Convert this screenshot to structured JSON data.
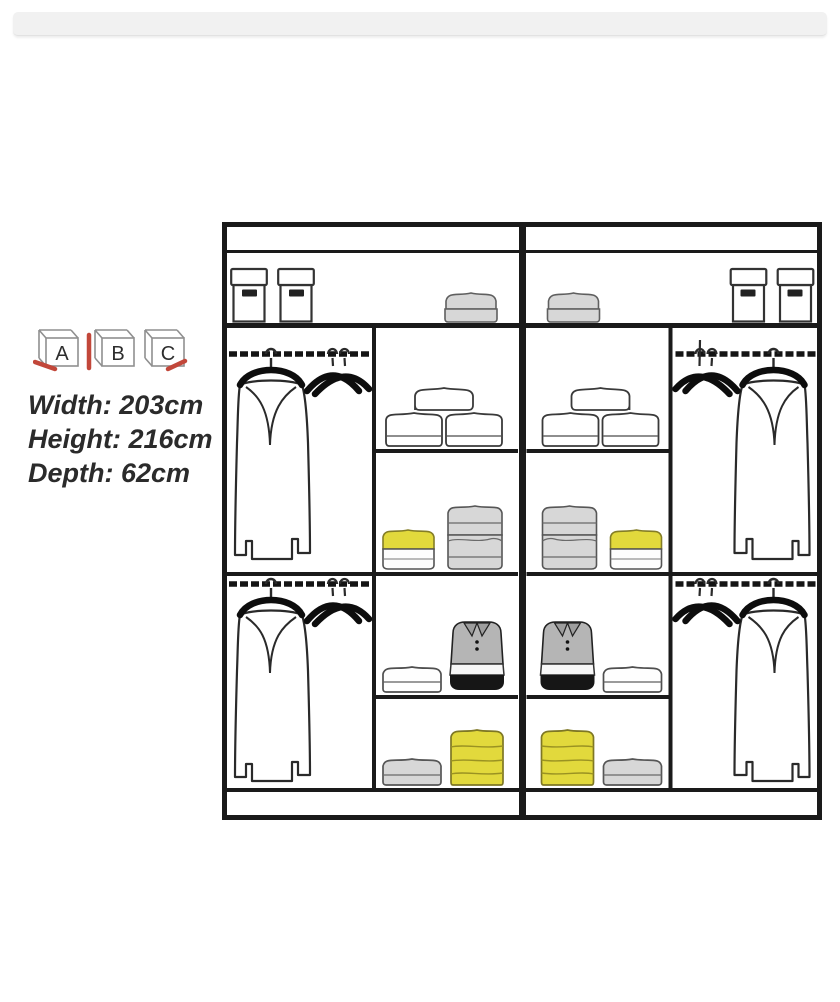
{
  "config_icons": {
    "options": [
      {
        "label": "A"
      },
      {
        "label": "B"
      },
      {
        "label": "C"
      }
    ]
  },
  "specs": {
    "width": "Width: 203cm",
    "height": "Height: 216cm",
    "depth": "Depth: 62cm"
  },
  "colors": {
    "line": "#1a1a1a",
    "accent-red": "#c2473a",
    "item-yellow": "#e2d93c",
    "item-gray": "#d7d7d7",
    "polo-gray": "#b5b5b5",
    "top-bar": "#f1f1f1",
    "text": "#2b2b2b"
  }
}
